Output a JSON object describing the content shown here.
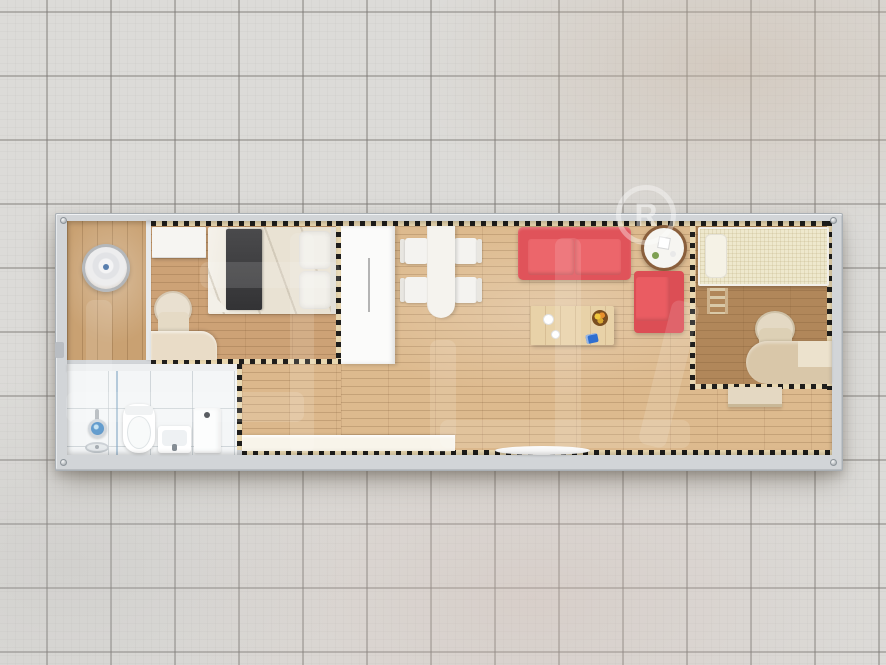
{
  "scene": {
    "title": "Container home floor plan - top view 3D render",
    "background": "gray ceramic tile floor"
  },
  "watermark": {
    "brand_text": "柜族",
    "registered_symbol": "R",
    "color": "#ffffff"
  },
  "palette": {
    "tile_floor": "#dcdbd8",
    "tile_grout": "#7a7773",
    "container_frame": "#d2d5d8",
    "porch_wood": "#c9a172",
    "bedroom1_wood": "#cda276",
    "living_wood": "#ddba8e",
    "bedroom2_wood": "#b1875a",
    "bathroom_tile": "#f4f6f7",
    "sofa_red": "#e0535a",
    "armchair_red": "#dc4e55",
    "bed1_runner_dark": "#3a3a3c",
    "bed2_mattress_cream": "#eee8cd",
    "dash_tan": "#e9d8b1",
    "dash_black": "#1f1e1c",
    "counter_white": "#f8f4ea"
  },
  "rooms": [
    {
      "name": "entry porch",
      "items": [
        "vertical wood deck",
        "round decor piece"
      ]
    },
    {
      "name": "bedroom 1",
      "items": [
        "double bed",
        "dark bed runner",
        "two pillows",
        "top cabinet",
        "desk",
        "round-back chair"
      ]
    },
    {
      "name": "bathroom",
      "items": [
        "shower head",
        "floor drain",
        "glass screen",
        "toilet",
        "wash basin",
        "tall cabinet"
      ]
    },
    {
      "name": "living dining",
      "items": [
        "white dining table",
        "four white chairs",
        "tall white wardrobe",
        "red two-seat sofa",
        "red armchair",
        "round side table",
        "wood coffee table",
        "fruit bowl",
        "white counter",
        "door mat"
      ]
    },
    {
      "name": "bedroom 2",
      "items": [
        "single loft bed",
        "pillow",
        "ladder",
        "corner desk",
        "round-back chair",
        "low cabinet"
      ]
    }
  ]
}
